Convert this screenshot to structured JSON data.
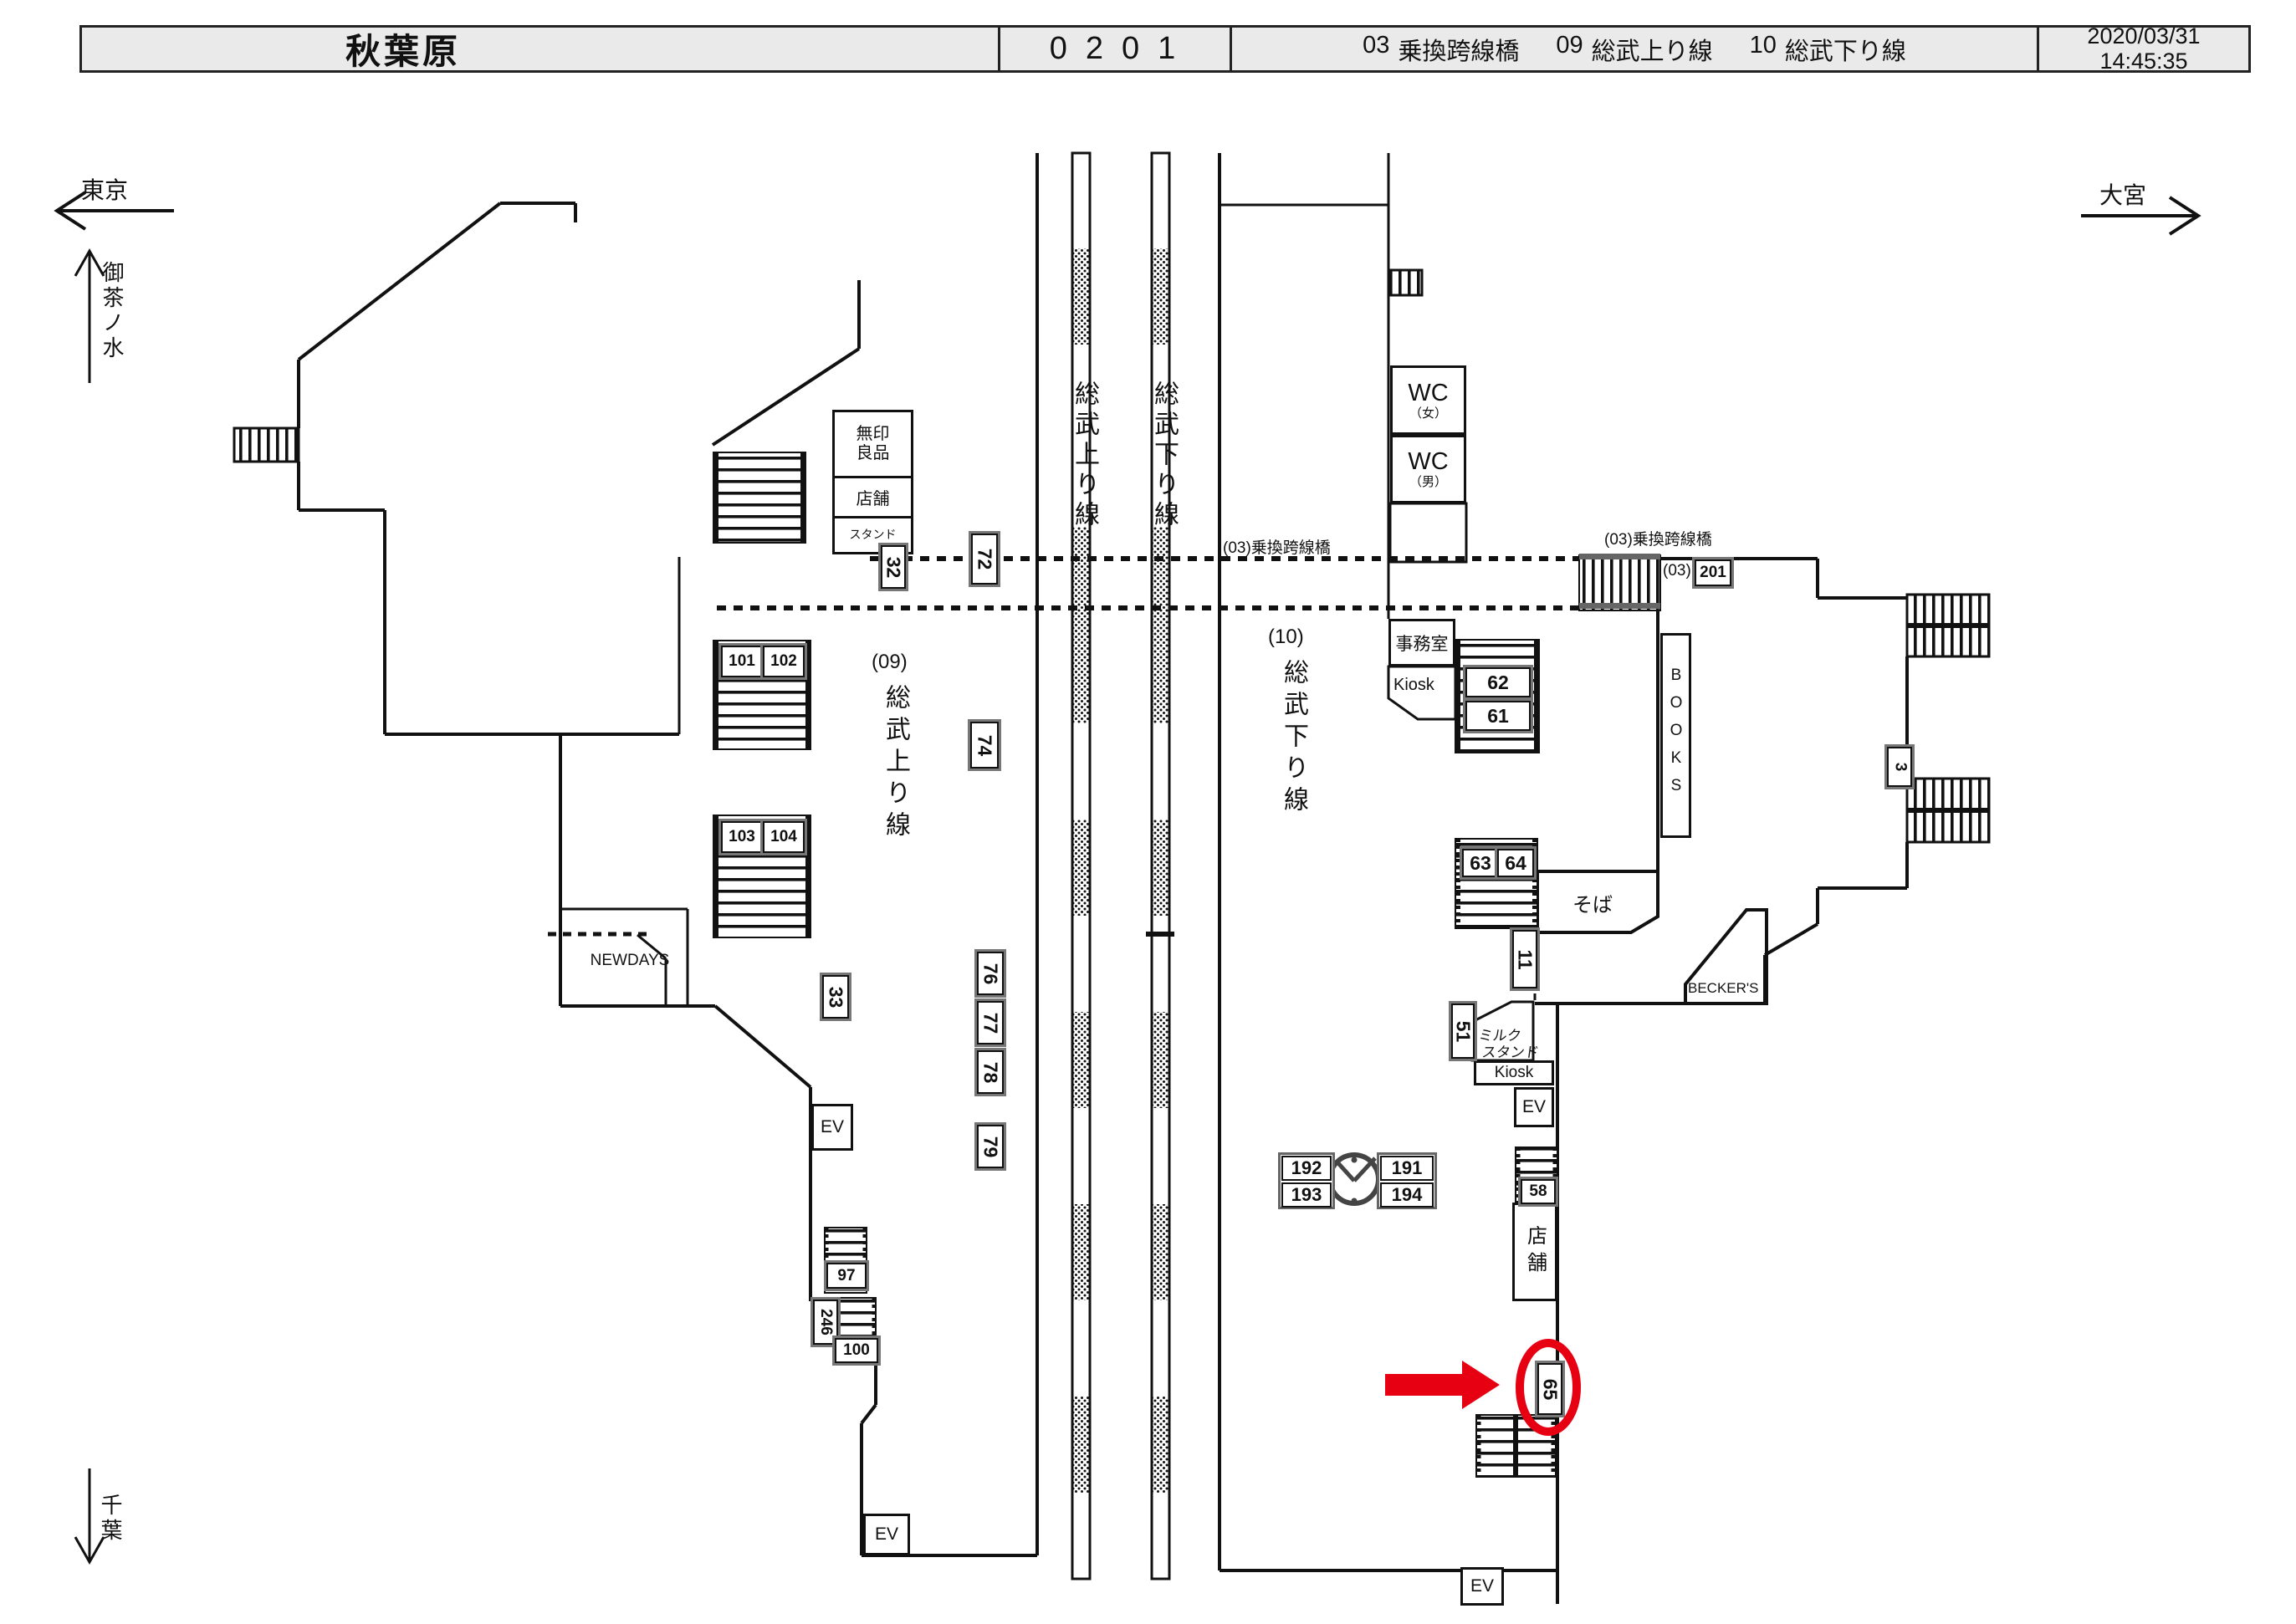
{
  "header": {
    "station": "秋葉原",
    "monitor_code": "0201",
    "legend": [
      {
        "no": "03",
        "name": "乗換跨線橋"
      },
      {
        "no": "09",
        "name": "総武上り線"
      },
      {
        "no": "10",
        "name": "総武下り線"
      }
    ],
    "date": "2020/03/31",
    "time": "14:45:35"
  },
  "directions": {
    "west": "東京",
    "east": "大宮",
    "north": "御茶ノ水",
    "south": "千葉"
  },
  "tracks": {
    "up_line": "総武上り線",
    "down_line": "総武下り線"
  },
  "platforms": {
    "p09_no": "(09)",
    "p09_name": "総武上り線",
    "p10_no": "(10)",
    "p10_name": "総武下り線"
  },
  "labels": {
    "bridge": "(03)乗換跨線橋",
    "bridge_no": "(03)",
    "muji_name": "無印良品",
    "muji_shop": "店舗",
    "muji_stand": "スタンド",
    "newdays": "NEWDAYS",
    "wc": "WC",
    "wc_female": "（女）",
    "wc_male": "（男）",
    "office": "事務室",
    "kiosk": "Kiosk",
    "books": "BOOKS",
    "soba": "そば",
    "milk_line1": "ミルク",
    "milk_line2": "スタンド",
    "beckers": "BECKER'S",
    "shop": "店舗",
    "ev": "EV"
  },
  "cameras": {
    "c32": "32",
    "c72": "72",
    "c101": "101",
    "c102": "102",
    "c103": "103",
    "c104": "104",
    "c74": "74",
    "c33": "33",
    "c76": "76",
    "c77": "77",
    "c78": "78",
    "c79": "79",
    "c97": "97",
    "c246": "246",
    "c100": "100",
    "c62": "62",
    "c61": "61",
    "c63": "63",
    "c64": "64",
    "c11": "11",
    "c51": "51",
    "c58": "58",
    "c192": "192",
    "c193": "193",
    "c191": "191",
    "c194": "194",
    "c201": "201",
    "c3": "3",
    "c65": "65"
  },
  "highlight": {
    "selected_camera": "65",
    "color": "#e60012"
  }
}
